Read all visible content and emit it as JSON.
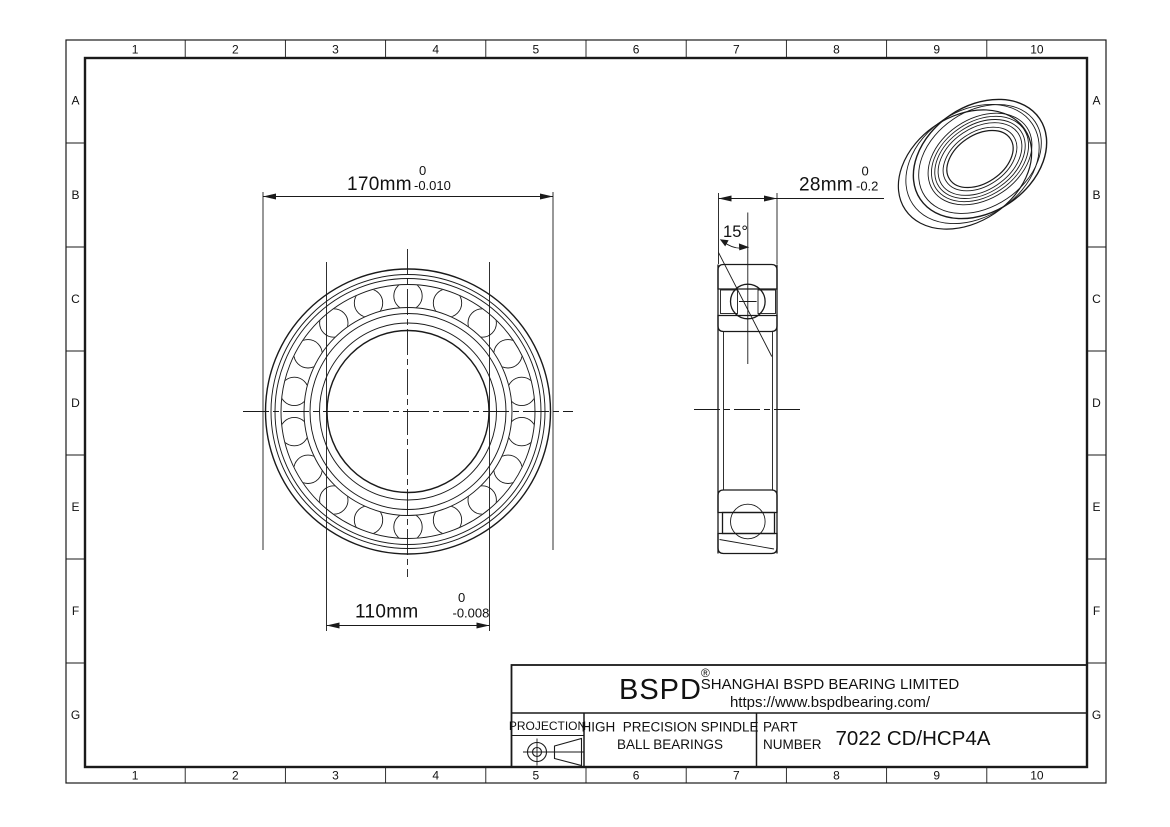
{
  "sheet": {
    "grid_columns": [
      "1",
      "2",
      "3",
      "4",
      "5",
      "6",
      "7",
      "8",
      "9",
      "10"
    ],
    "grid_rows": [
      "A",
      "B",
      "C",
      "D",
      "E",
      "F",
      "G"
    ]
  },
  "dimensions": {
    "outer_diameter": {
      "value": "170mm",
      "tolerance_upper": "0",
      "tolerance_lower": "-0.010"
    },
    "bore_diameter": {
      "value": "110mm",
      "tolerance_upper": "0",
      "tolerance_lower": "-0.008"
    },
    "width": {
      "value": "28mm",
      "tolerance_upper": "0",
      "tolerance_lower": "-0.2"
    },
    "contact_angle": {
      "value": "15°"
    }
  },
  "title_block": {
    "logo": "BSPD",
    "registered_mark": "®",
    "company_name": "SHANGHAI BSPD BEARING LIMITED",
    "website": "https://www.bspdbearing.com/",
    "projection_label": "PROJECTION",
    "product_line1": "HIGH  PRECISION SPINDLE",
    "product_line2": "BALL BEARINGS",
    "part_label_line1": "PART",
    "part_label_line2": "NUMBER",
    "part_number": "7022 CD/HCP4A"
  },
  "colors": {
    "line": "#1a1a1a",
    "background": "#ffffff"
  }
}
